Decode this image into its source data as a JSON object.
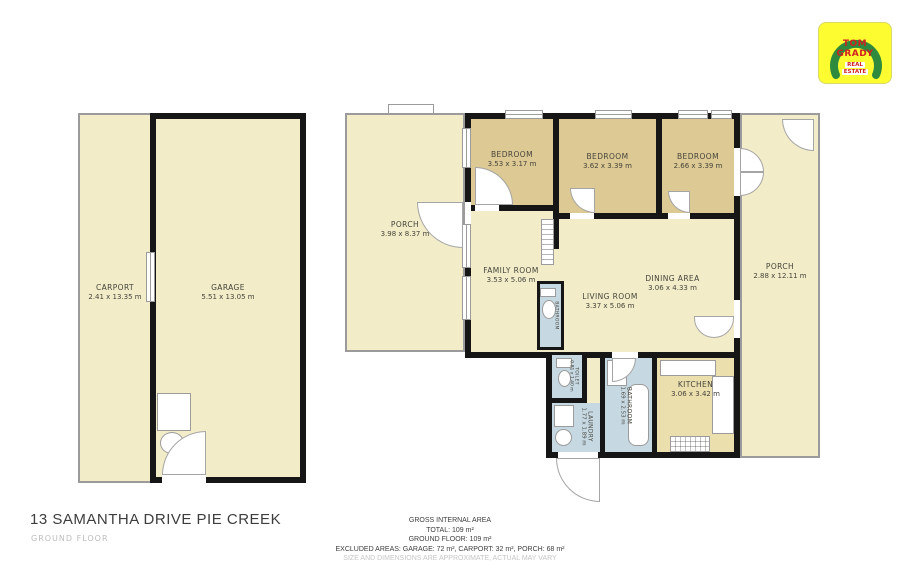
{
  "logo": {
    "line1": "TOM",
    "line2": "GRADY",
    "line3": "REAL",
    "line4": "ESTATE"
  },
  "rooms": {
    "carport": {
      "label": "CARPORT",
      "dims": "2.41 x 13.35 m"
    },
    "garage": {
      "label": "GARAGE",
      "dims": "5.51 x 13.05 m"
    },
    "porch_left": {
      "label": "PORCH",
      "dims": "3.98 x 8.37 m"
    },
    "bedroom_1": {
      "label": "BEDROOM",
      "dims": "3.53 x 3.17 m"
    },
    "bedroom_2": {
      "label": "BEDROOM",
      "dims": "3.62 x 3.39 m"
    },
    "bedroom_3": {
      "label": "BEDROOM",
      "dims": "2.66 x 3.39 m"
    },
    "family_room": {
      "label": "FAMILY ROOM",
      "dims": "3.53 x 5.06 m"
    },
    "living_room": {
      "label": "LIVING ROOM",
      "dims": "3.37 x 5.06 m"
    },
    "dining_area": {
      "label": "DINING AREA",
      "dims": "3.06 x 4.33 m"
    },
    "porch_right": {
      "label": "PORCH",
      "dims": "2.88 x 12.11 m"
    },
    "kitchen": {
      "label": "KITCHEN",
      "dims": "3.06 x 3.42 m"
    },
    "bathroom": {
      "label": "BATHROOM",
      "dims": "1.69 x 2.53 m"
    },
    "laundry": {
      "label": "LAUNDRY",
      "dims": "1.77 x 1.89 m"
    },
    "toilet": {
      "label": "TOILET",
      "dims": "0.81 x 1.40 m"
    },
    "bathroom_small": {
      "label": "BATHROOM",
      "dims": ""
    }
  },
  "footer": {
    "title": "13 SAMANTHA DRIVE PIE CREEK",
    "subtitle": "GROUND FLOOR"
  },
  "area_summary": {
    "heading": "GROSS INTERNAL AREA",
    "total": "TOTAL: 109 m²",
    "ground_floor": "GROUND FLOOR: 109 m²",
    "excluded": "EXCLUDED AREAS: GARAGE: 72 m², CARPORT: 32 m², PORCH: 68 m²",
    "disclaimer": "SIZE AND DIMENSIONS ARE APPROXIMATE, ACTUAL MAY VARY"
  },
  "colors": {
    "room_fill": "#f2edc8",
    "bedroom_fill": "#ddc993",
    "wet_room_fill": "#c6d8e2",
    "kitchen_fill": "#ecdfae",
    "wall": "#161616",
    "porch_outline": "#9b9b9b",
    "logo_yellow": "#fcfc30",
    "logo_green": "#2e8b3d",
    "logo_red": "#d02020"
  }
}
